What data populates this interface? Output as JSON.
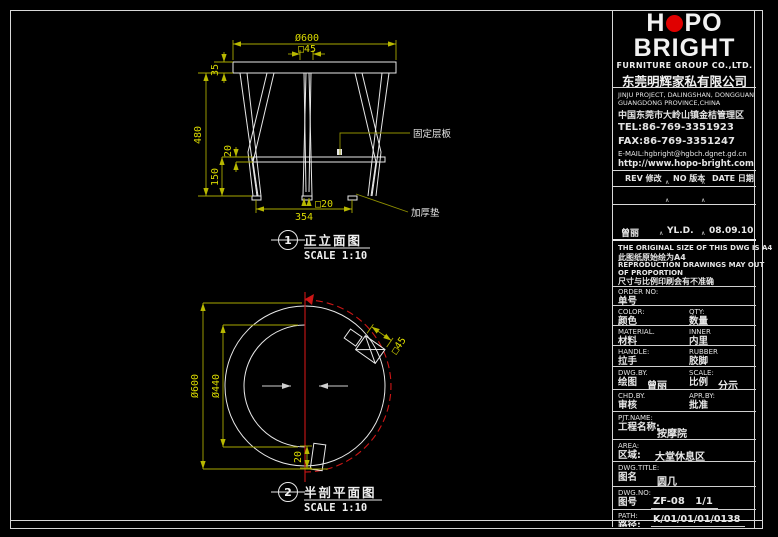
{
  "colors": {
    "accent_red": "#e00000",
    "line": "#e8e8e8",
    "dim": "#d9d900"
  },
  "logo": {
    "brand_h": "H",
    "brand_po": "PO",
    "brand_line2": "BRIGHT",
    "subtitle": "FURNITURE GROUP CO.,LTD.",
    "company_cn": "东莞明辉家私有限公司"
  },
  "contact": {
    "address_en1": "JINJU PROJECT, DALINGSHAN, DONGGUAN",
    "address_en2": "GUANGDONG PROVINCE,CHINA",
    "address_cn": "中国东莞市大岭山镇金桔管理区",
    "tel": "TEL:86-769-3351923",
    "fax": "FAX:86-769-3351247",
    "email": "E-MAIL:hgbright@hgbch.dgnet.gd.cn",
    "website": "http://www.hopo-bright.com"
  },
  "revision": {
    "rev_header": "REV 修改",
    "no_header": "NO 版本",
    "date_header": "DATE 日期",
    "caret": "∧",
    "name": "曾丽",
    "no": "YL.D.",
    "date": "08.09.10"
  },
  "notes": {
    "l1": "THE ORIGINAL SIZE OF THIS DWG IS A4",
    "l2": "此图纸原始绘为A4",
    "l3": "REPRODUCTION DRAWINGS MAY OUT",
    "l4": "OF PROPORTION",
    "l5": "尺寸与比例印刷会有不准确"
  },
  "tb": {
    "order_en": "ORDER NO:",
    "order_cn": "单号",
    "color_en": "COLOR:",
    "color_cn": "颜色",
    "qty_en": "QTY:",
    "qty_cn": "数量",
    "material_en": "MATERIAL.",
    "material_cn": "材料",
    "inner_en": "INNER",
    "inner_cn": "内里",
    "handle_en": "HANDLE:",
    "handle_cn": "拉手",
    "rubber_en": "RUBBER",
    "rubber_cn": "胶脚",
    "dwgby_en": "DWG.BY.",
    "dwgby_cn": "绘图",
    "dwgby_val": "曾丽",
    "scale_en": "SCALE:",
    "scale_cn": "比例",
    "scale_val": "分示",
    "chd_en": "CHD.BY.",
    "chd_cn": "审核",
    "apr_en": "APR.BY:",
    "apr_cn": "批准",
    "pjt_en": "PJT.NAME:",
    "pjt_cn": "工程名称:",
    "pjt_val": "按摩院",
    "area_en": "AREA:",
    "area_cn": "区域:",
    "area_val": "大堂休息区",
    "title_en": "DWG.TITLE:",
    "title_cn": "图名",
    "title_val": "圆几",
    "no_en": "DWG.NO:",
    "no_cn": "图号",
    "no_val": "ZF-08",
    "no_pages": "1/1",
    "path_en": "PATH:",
    "path_cn": "路径:",
    "path_val": "K/01/01/01/0138"
  },
  "views": {
    "e_no": "1",
    "e_title": "正立面图",
    "e_scale": "SCALE 1:10",
    "p_no": "2",
    "p_title": "半剖平面图",
    "p_scale": "SCALE 1:10",
    "shelf_label": "固定层板",
    "pad_label": "加厚垫"
  },
  "dims": {
    "d600": "Ø600",
    "d45": "□45",
    "d35": "35",
    "d480": "480",
    "d20": "20",
    "d150": "150",
    "d20sq": "□20",
    "d354": "354",
    "p600": "Ø600",
    "p440": "Ø440",
    "p45": "□45",
    "p20": "20"
  }
}
